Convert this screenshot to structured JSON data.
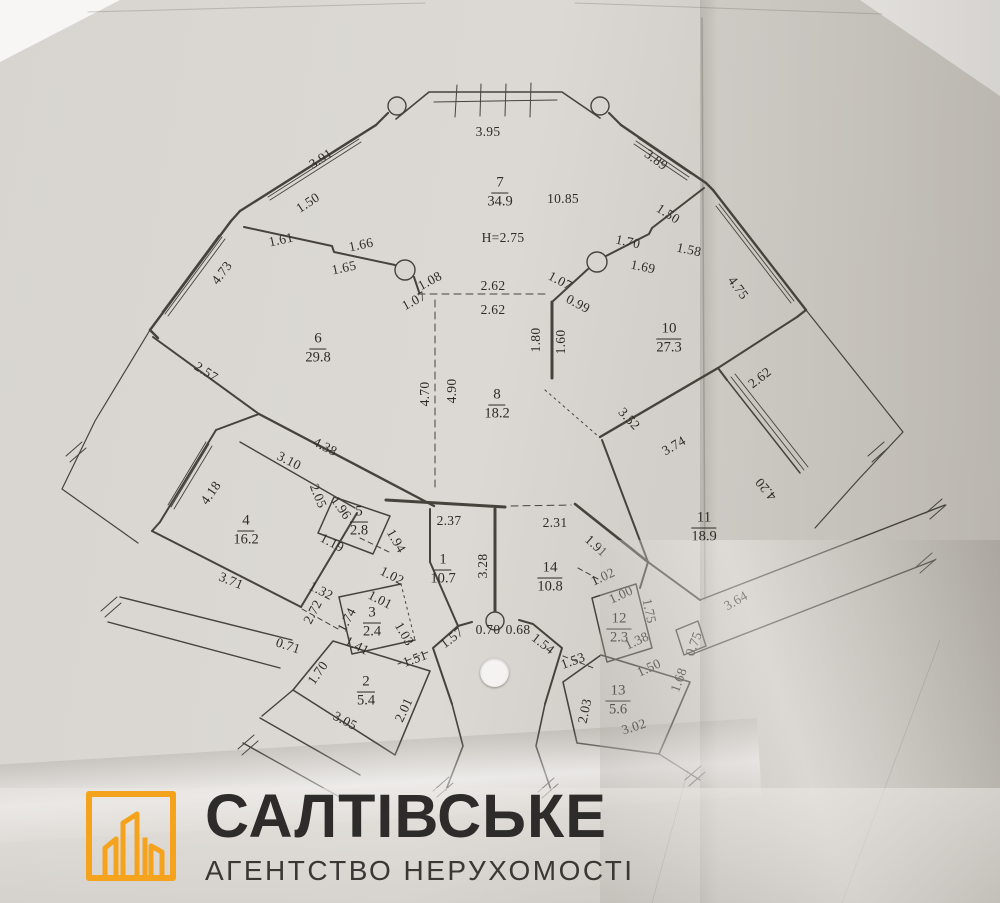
{
  "plan": {
    "rooms": [
      {
        "num": "7",
        "area": "34.9",
        "x": 500,
        "y": 192
      },
      {
        "num": "6",
        "area": "29.8",
        "x": 318,
        "y": 348
      },
      {
        "num": "10",
        "area": "27.3",
        "x": 669,
        "y": 338
      },
      {
        "num": "8",
        "area": "18.2",
        "x": 497,
        "y": 404
      },
      {
        "num": "4",
        "area": "16.2",
        "x": 246,
        "y": 530
      },
      {
        "num": "5",
        "area": "2.8",
        "x": 359,
        "y": 521
      },
      {
        "num": "1",
        "area": "10.7",
        "x": 443,
        "y": 569
      },
      {
        "num": "14",
        "area": "10.8",
        "x": 550,
        "y": 577
      },
      {
        "num": "11",
        "area": "18.9",
        "x": 704,
        "y": 527
      },
      {
        "num": "3",
        "area": "2.4",
        "x": 372,
        "y": 622
      },
      {
        "num": "12",
        "area": "2.3",
        "x": 619,
        "y": 628
      },
      {
        "num": "2",
        "area": "5.4",
        "x": 366,
        "y": 691
      },
      {
        "num": "13",
        "area": "5.6",
        "x": 618,
        "y": 700
      }
    ],
    "dims": [
      {
        "t": "3.95",
        "x": 488,
        "y": 132,
        "r": 0
      },
      {
        "t": "3.91",
        "x": 321,
        "y": 159,
        "r": -33
      },
      {
        "t": "1.50",
        "x": 308,
        "y": 203,
        "r": -33
      },
      {
        "t": "1.61",
        "x": 281,
        "y": 240,
        "r": -12
      },
      {
        "t": "1.66",
        "x": 361,
        "y": 245,
        "r": -12
      },
      {
        "t": "1.65",
        "x": 344,
        "y": 268,
        "r": -12
      },
      {
        "t": "1.08",
        "x": 430,
        "y": 281,
        "r": -28
      },
      {
        "t": "1.07",
        "x": 414,
        "y": 301,
        "r": -28
      },
      {
        "t": "2.62",
        "x": 493,
        "y": 286,
        "r": 0
      },
      {
        "t": "2.62",
        "x": 493,
        "y": 310,
        "r": 0
      },
      {
        "t": "1.07",
        "x": 560,
        "y": 281,
        "r": 28
      },
      {
        "t": "0.99",
        "x": 578,
        "y": 304,
        "r": 28
      },
      {
        "t": "1.70",
        "x": 628,
        "y": 242,
        "r": 12
      },
      {
        "t": "1.69",
        "x": 643,
        "y": 267,
        "r": 12
      },
      {
        "t": "1.58",
        "x": 689,
        "y": 250,
        "r": 12
      },
      {
        "t": "1.50",
        "x": 668,
        "y": 214,
        "r": 33
      },
      {
        "t": "3.89",
        "x": 656,
        "y": 160,
        "r": 37
      },
      {
        "t": "4.73",
        "x": 222,
        "y": 273,
        "r": -53
      },
      {
        "t": "4.75",
        "x": 738,
        "y": 288,
        "r": 53
      },
      {
        "t": "10.85",
        "x": 563,
        "y": 199,
        "r": 0
      },
      {
        "t": "H=2.75",
        "x": 503,
        "y": 238,
        "r": 0
      },
      {
        "t": "1.80",
        "x": 536,
        "y": 340,
        "r": -90
      },
      {
        "t": "1.60",
        "x": 561,
        "y": 342,
        "r": -90
      },
      {
        "t": "2.57",
        "x": 206,
        "y": 372,
        "r": 33
      },
      {
        "t": "4.70",
        "x": 425,
        "y": 394,
        "r": -90
      },
      {
        "t": "4.90",
        "x": 452,
        "y": 391,
        "r": -90
      },
      {
        "t": "3.52",
        "x": 629,
        "y": 419,
        "r": 47
      },
      {
        "t": "3.74",
        "x": 674,
        "y": 446,
        "r": -30
      },
      {
        "t": "2.62",
        "x": 760,
        "y": 378,
        "r": -38
      },
      {
        "t": "4.20",
        "x": 766,
        "y": 489,
        "r": 230
      },
      {
        "t": "4.38",
        "x": 325,
        "y": 447,
        "r": 27
      },
      {
        "t": "3.10",
        "x": 289,
        "y": 461,
        "r": 27
      },
      {
        "t": "4.18",
        "x": 211,
        "y": 493,
        "r": -55
      },
      {
        "t": "2.05",
        "x": 318,
        "y": 496,
        "r": 68
      },
      {
        "t": "1.96",
        "x": 341,
        "y": 508,
        "r": 55
      },
      {
        "t": "1.19",
        "x": 332,
        "y": 543,
        "r": 28
      },
      {
        "t": "1.94",
        "x": 396,
        "y": 541,
        "r": 60
      },
      {
        "t": "2.37",
        "x": 449,
        "y": 521,
        "r": 0
      },
      {
        "t": "2.31",
        "x": 555,
        "y": 523,
        "r": 0
      },
      {
        "t": "1.91",
        "x": 596,
        "y": 546,
        "r": 42
      },
      {
        "t": "3.28",
        "x": 483,
        "y": 566,
        "r": -90
      },
      {
        "t": "1.02",
        "x": 392,
        "y": 576,
        "r": 27
      },
      {
        "t": "1.01",
        "x": 380,
        "y": 600,
        "r": 27
      },
      {
        "t": "1.74",
        "x": 347,
        "y": 620,
        "r": -62
      },
      {
        "t": "1.03",
        "x": 404,
        "y": 634,
        "r": 60
      },
      {
        "t": "1.41",
        "x": 357,
        "y": 646,
        "r": 27
      },
      {
        "t": "1.32",
        "x": 321,
        "y": 591,
        "r": 27
      },
      {
        "t": "2.72",
        "x": 313,
        "y": 612,
        "r": -62
      },
      {
        "t": "3.71",
        "x": 231,
        "y": 581,
        "r": 22
      },
      {
        "t": "0.71",
        "x": 288,
        "y": 646,
        "r": 18
      },
      {
        "t": "1.70",
        "x": 318,
        "y": 673,
        "r": -55
      },
      {
        "t": "1.51",
        "x": 415,
        "y": 659,
        "r": -20
      },
      {
        "t": "3.05",
        "x": 345,
        "y": 721,
        "r": 28
      },
      {
        "t": "2.01",
        "x": 404,
        "y": 710,
        "r": -65
      },
      {
        "t": "0.70",
        "x": 488,
        "y": 630,
        "r": 0
      },
      {
        "t": "0.68",
        "x": 518,
        "y": 630,
        "r": 0
      },
      {
        "t": "1.57",
        "x": 452,
        "y": 638,
        "r": -38
      },
      {
        "t": "1.54",
        "x": 543,
        "y": 644,
        "r": 38
      },
      {
        "t": "1.53",
        "x": 573,
        "y": 661,
        "r": -20
      },
      {
        "t": "2.03",
        "x": 585,
        "y": 711,
        "r": -78
      },
      {
        "t": "3.02",
        "x": 634,
        "y": 727,
        "r": -18
      },
      {
        "t": "1.50",
        "x": 649,
        "y": 668,
        "r": -25
      },
      {
        "t": "1.68",
        "x": 679,
        "y": 680,
        "r": -70
      },
      {
        "t": "0.75",
        "x": 694,
        "y": 644,
        "r": -70
      },
      {
        "t": "1.02",
        "x": 603,
        "y": 577,
        "r": -25
      },
      {
        "t": "1.00",
        "x": 621,
        "y": 595,
        "r": -25
      },
      {
        "t": "1.75",
        "x": 649,
        "y": 611,
        "r": 78
      },
      {
        "t": "1.38",
        "x": 637,
        "y": 641,
        "r": -25
      },
      {
        "t": "3.64",
        "x": 736,
        "y": 601,
        "r": -30
      }
    ]
  },
  "logo": {
    "title": "САЛТІВСЬКЕ",
    "subtitle": "АГЕНТСТВО НЕРУХОМОСТІ",
    "accent": "#F5A21D"
  }
}
